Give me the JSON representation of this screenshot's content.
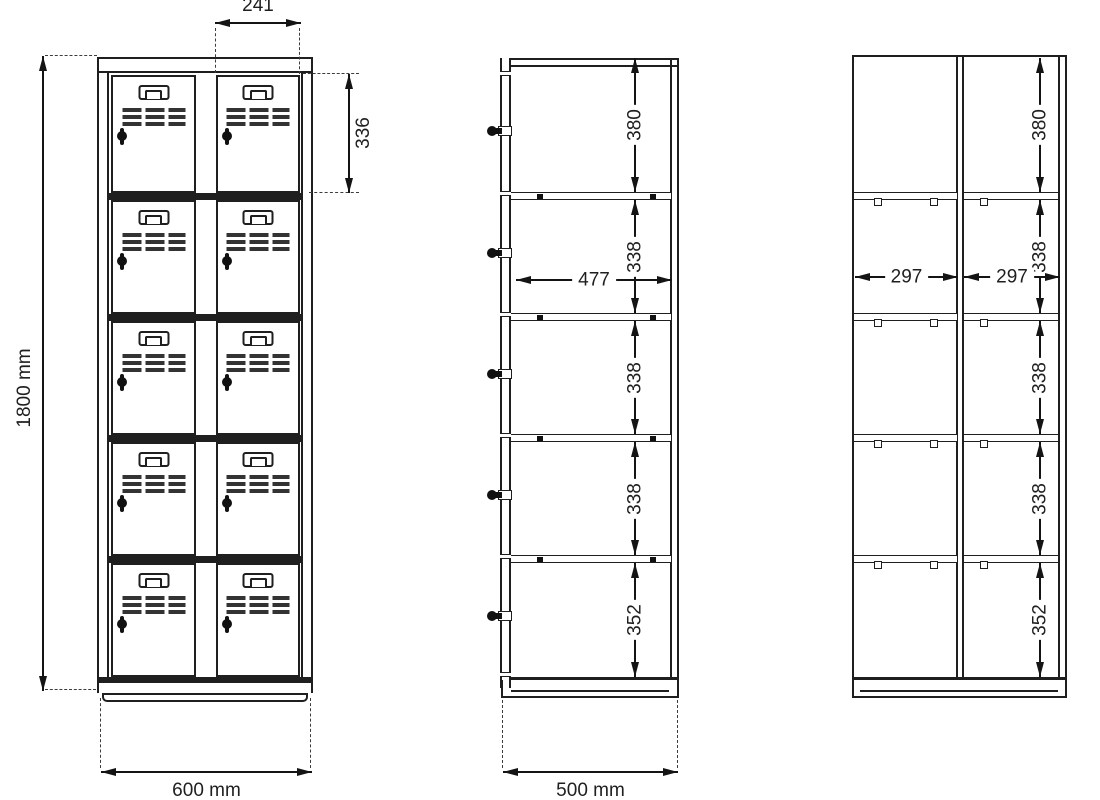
{
  "drawing": {
    "line_color": "#1f1f1f",
    "background_color": "#ffffff"
  },
  "front_view": {
    "columns": 2,
    "doors_per_column": 5,
    "features": [
      "door-handle",
      "vent-grille",
      "cylinder-lock"
    ],
    "dimensions": {
      "door_column_width": "241",
      "first_door_height": "336",
      "total_height": "1800 mm",
      "total_width": "600 mm"
    }
  },
  "side_view": {
    "locks_on_edge": 5,
    "dimensions": {
      "compartments": [
        "380",
        "338",
        "338",
        "338",
        "352"
      ],
      "interior_depth": "477",
      "total_depth": "500 mm"
    }
  },
  "open_front_view": {
    "columns": 2,
    "dimensions": {
      "compartments": [
        "380",
        "338",
        "338",
        "338",
        "352"
      ],
      "left_column_width": "297",
      "right_column_width": "297"
    }
  }
}
